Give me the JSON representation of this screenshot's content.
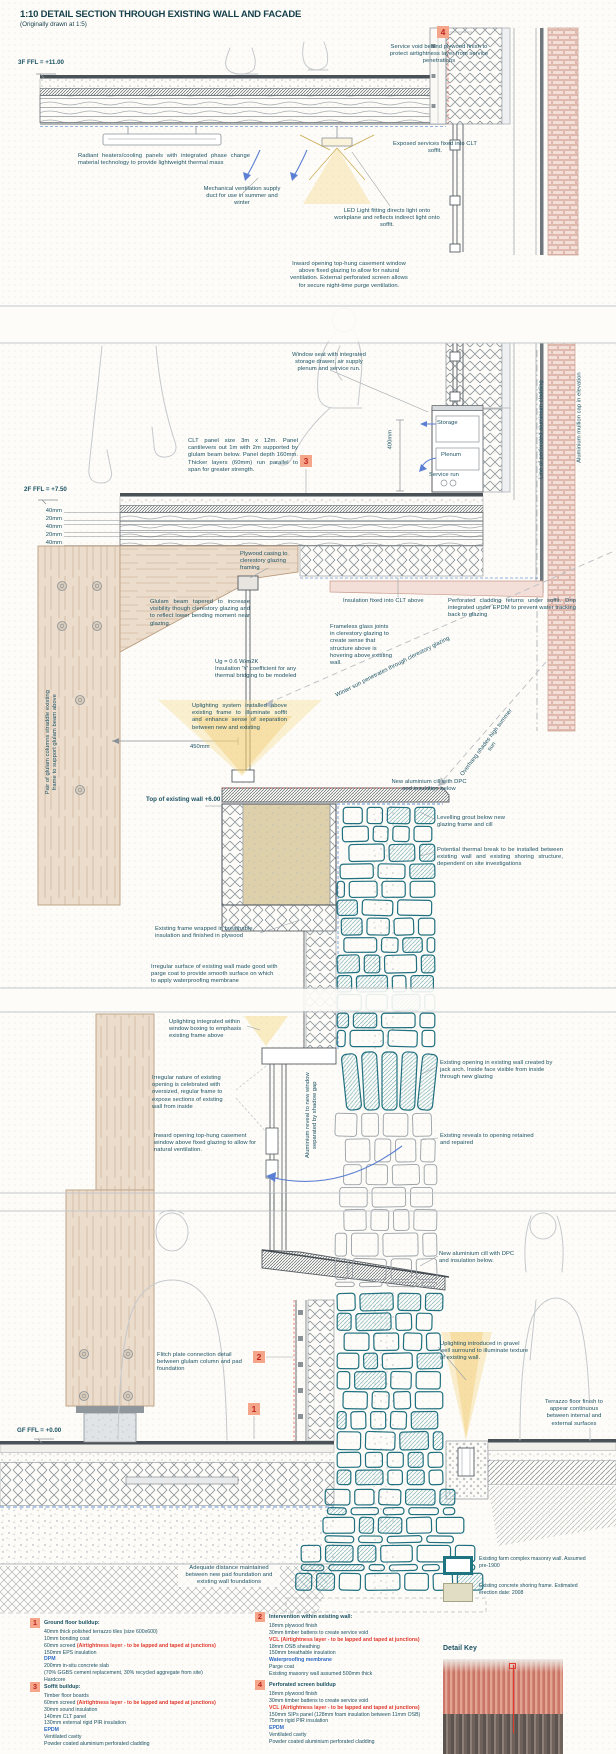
{
  "title": {
    "main": "1:10 DETAIL SECTION THROUGH EXISTING WALL AND FACADE",
    "sub": "(Originally drawn at 1:5)"
  },
  "levels": [
    {
      "id": "lvl_3f",
      "text": "3F FFL = +11.00"
    },
    {
      "id": "lvl_2f",
      "text": "2F FFL = +7.50"
    },
    {
      "id": "lvl_wall",
      "text": "Top of existing wall +6.00"
    },
    {
      "id": "lvl_gf",
      "text": "GF FFL = +0.00"
    }
  ],
  "markers": [
    {
      "id": "m1",
      "label": "1"
    },
    {
      "id": "m2",
      "label": "2"
    },
    {
      "id": "m3",
      "label": "3"
    },
    {
      "id": "m4",
      "label": "4"
    }
  ],
  "annotations": {
    "svc_void": "Service void behind plywood finish to protect airtightness layer from service penetrations",
    "radiant": "Radiant heaters/cooling panels with integrated phase change material technology to provide lightweight thermal mass",
    "mech_vent": "Mechanical ventilation supply duct for use in summer and winter",
    "exposed": "Exposed services fixed into CLT soffit.",
    "led": "LED Light fitting directs light onto workplane and reflects indirect light onto soffit.",
    "inward_top": "Inward opening top-hung casement window above fixed glazing to allow for natural ventilation. External perforated screen allows for secure night-time purge ventilation.",
    "window_seat": "Window seat with integrated storage drawer, air supply plenum and service run.",
    "storage": "Storage",
    "plenum": "Plenum",
    "service_run": "Service run",
    "dim_400": "400mm",
    "clt_panel": "CLT panel size 3m x 12m. Panel cantilevers out 1m with 2m supported by glulam beam below. Panel depth 160mm. Thicker layers (60mm) run parallel to span for greater strength.",
    "dim_f1": "40mm",
    "dim_f2": "20mm",
    "dim_f3": "40mm",
    "dim_f4": "20mm",
    "dim_f5": "40mm",
    "plywood_casing": "Plywood casing to clerestory glazing framing",
    "insul_clt": "Insulation fixed into CLT above",
    "perf_returns": "Perforated cladding returns under soffit. Drip integrated under EPDM to prevent water tracking back to glazing",
    "frameless": "Frameless glass joints in clerestory glazing to create sense that structure above is hovering above existing wall.",
    "glulam_taper": "Glulam beam tapered to increase visibility though clerestory glazing and to reflect lower bending moment near glazing.",
    "ug": "Ug = 0.6 W/m2K\nInsulation 'Y' coefficient for any thermal bridging to be modeled",
    "uplight_sys": "Uplighting system installed above existing frame to illuminate soffit and enhance sense of separation between new and existing",
    "dim_450": "450mm",
    "winter_sun": "Winter sun penetrates through clerestory glazing",
    "overhang": "Overhang shades high summer sun",
    "cill1": "New aluminium cill with DPC and insulation below",
    "levelling": "Levelling grout below new glazing frame and cill",
    "thermal_break": "Potential thermal break to be installed between existing wall and existing shoring structure, dependent on site investigations",
    "frame_wrapped": "Existing frame wrapped in breathable insulation and finished in plywood",
    "irregular_surface": "Irregular surface of existing wall made good with parge coat to provide smooth surface on which to apply waterproofing membrane",
    "uplight_boxing": "Uplighting integrated within window boxing to emphasis existing frame above",
    "existing_opening": "Existing opening in existing wall created by jack arch. Inside face visible from inside through new glazing",
    "irregular_nature": "Irregular nature of existing opening is celebrated with oversized, regular frame to expose sections of existing wall from inside",
    "inward_lower": "Inward opening top-hung casement window above fixed glazing to allow for natural ventilation.",
    "alu_reveal": "Aluminium reveal to new window separated by shadow gap",
    "reveals": "Existing reveals to opening retained and repaired",
    "cill2": "New aluminium cill with DPC and insulation below.",
    "flitch": "Flitch plate connection detail between glulam column and pad foundation",
    "uplight_gravel": "Uplighting introduced in gravel well surround to illuminate texture of existing wall.",
    "terrazzo_cont": "Terrazzo floor finish to appear continuous between internal and external surfaces",
    "adequate": "Adequate distance maintained between new pad foundation and existing wall foundations",
    "line_perf": "Line of perforated aluminium cladding",
    "mullion_cap": "Aluminium mullion cap in elevation",
    "glulam_pair": "Pair of glulam columns straddle existing frame to support glulam beam above"
  },
  "notes": [
    {
      "num": "1",
      "title": "Ground floor buildup:",
      "lines": [
        [
          [
            "40mm thick polished terrazzo tiles (size 600x600)",
            ""
          ]
        ],
        [
          [
            "10mm bonding coat",
            ""
          ]
        ],
        [
          [
            "60mm screed ",
            ""
          ],
          [
            "(Airtightness layer - to be lapped and taped at junctions)",
            "red"
          ]
        ],
        [
          [
            "150mm EPS insulation",
            ""
          ]
        ],
        [
          [
            "DPM",
            "blue"
          ]
        ],
        [
          [
            "200mm in-situ concrete slab",
            ""
          ]
        ],
        [
          [
            "(70% GGBS cement replacement, 30% recycled aggregate from site)",
            ""
          ]
        ],
        [
          [
            "Hardcore",
            ""
          ]
        ]
      ]
    },
    {
      "num": "2",
      "title": "Intervention within existing wall:",
      "lines": [
        [
          [
            "18mm plywood finish",
            ""
          ]
        ],
        [
          [
            "30mm timber battens to create service void",
            ""
          ]
        ],
        [
          [
            "VCL (Airtightness layer - to be lapped and taped at junctions)",
            "red"
          ]
        ],
        [
          [
            "18mm OSB sheathing",
            ""
          ]
        ],
        [
          [
            "150mm breathable insulation",
            ""
          ]
        ],
        [
          [
            "Waterproofing membrane",
            "blue"
          ]
        ],
        [
          [
            "Parge coat",
            ""
          ]
        ],
        [
          [
            "Existing masonry wall assumed 500mm thick",
            ""
          ]
        ]
      ]
    },
    {
      "num": "3",
      "title": "Soffit buildup:",
      "lines": [
        [
          [
            "Timber floor boards",
            ""
          ]
        ],
        [
          [
            "60mm screed ",
            ""
          ],
          [
            "(Airtightness layer - to be lapped and taped at junctions)",
            "red"
          ]
        ],
        [
          [
            "30mm sound insulation",
            ""
          ]
        ],
        [
          [
            "140mm CLT panel",
            ""
          ]
        ],
        [
          [
            "130mm external rigid PIR insulation",
            ""
          ]
        ],
        [
          [
            "EPDM",
            "blue"
          ]
        ],
        [
          [
            "Ventilated cavity",
            ""
          ]
        ],
        [
          [
            "Powder coated aluminium perforated cladding",
            ""
          ]
        ]
      ]
    },
    {
      "num": "4",
      "title": "Perforated screen buildup",
      "lines": [
        [
          [
            "18mm plywood finish",
            ""
          ]
        ],
        [
          [
            "30mm timber battens to create service void",
            ""
          ]
        ],
        [
          [
            "VCL (Airtightness layer - to be lapped and taped at junctions)",
            "red"
          ]
        ],
        [
          [
            "150mm SIPs panel (128mm foam insulation between 11mm OSB)",
            ""
          ]
        ],
        [
          [
            "75mm rigid PIR insulation",
            ""
          ]
        ],
        [
          [
            "EPDM",
            "blue"
          ]
        ],
        [
          [
            "Ventilated cavity",
            ""
          ]
        ],
        [
          [
            "Powder coated aluminium perforated cladding",
            ""
          ]
        ]
      ]
    }
  ],
  "legend": [
    {
      "id": "masonry",
      "text": "Existing farm complex masonry wall. Assumed pre-1900"
    },
    {
      "id": "shoring",
      "text": "Existing concrete shoring frame. Estimated erection date: 2008"
    }
  ],
  "detail_key": {
    "title": "Detail Key"
  },
  "colors": {
    "annotation_text": "#1b5264",
    "accent_teal": "#1f7482",
    "red": "#e0392e",
    "blue": "#2f6bc6",
    "marker_bg": "#f4a58a",
    "marker_text": "#c0271d",
    "glulam": "#ecdccb",
    "existing_frame_tan": "#ddd0ab",
    "cladding_pink": "#f3ded8",
    "light_yellow": "#f5d98c"
  }
}
